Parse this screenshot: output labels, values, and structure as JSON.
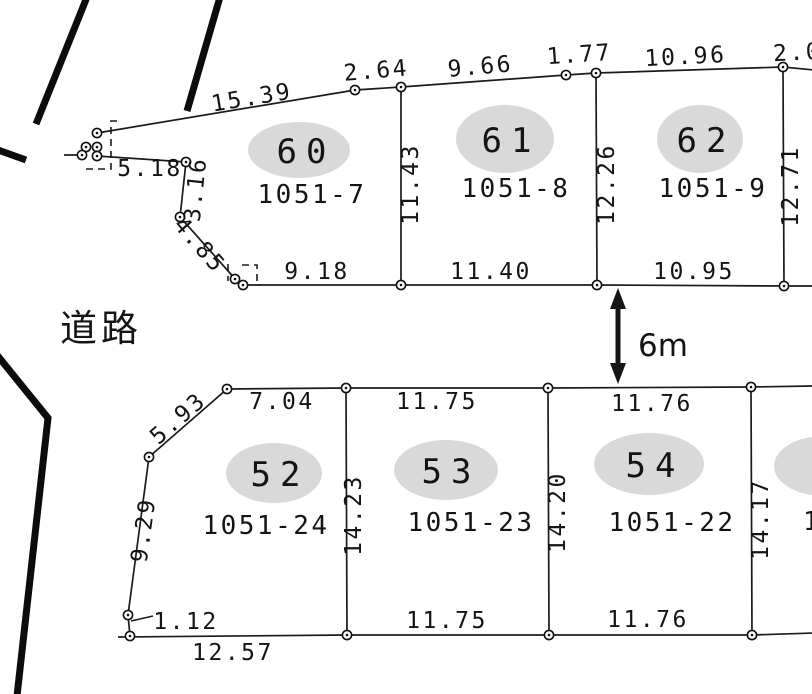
{
  "colors": {
    "paper": "#ffffff",
    "ink": "#141414",
    "road_edge": "#0c0c0c",
    "parcel_ellipse": "#d9d9d9"
  },
  "road": {
    "label": "道路",
    "width_label": "6m"
  },
  "parcels": [
    {
      "number": "60",
      "lot_id": "1051-7"
    },
    {
      "number": "61",
      "lot_id": "1051-8"
    },
    {
      "number": "62",
      "lot_id": "1051-9"
    },
    {
      "number": "52",
      "lot_id": "1051-24"
    },
    {
      "number": "53",
      "lot_id": "1051-23"
    },
    {
      "number": "54",
      "lot_id": "1051-22"
    }
  ],
  "partial_parcel": {
    "lot_id_fragment": "1"
  },
  "measurements": {
    "p60_top": "15.39",
    "p60_top_right": "2.64",
    "p61_top": "9.66",
    "p61_top_right": "1.77",
    "p62_top": "10.96",
    "p62_top_right": "2.0",
    "p60_p61_side": "11.43",
    "p61_p62_side": "12.26",
    "p62_right_side": "12.71",
    "p60_left_a": "5.18",
    "p60_left_b": "3.16",
    "p60_left_c": "4.85",
    "p60_bottom": "9.18",
    "p61_bottom": "11.40",
    "p62_bottom": "10.95",
    "p52_diagonal": "5.93",
    "p52_top": "7.04",
    "p53_top": "11.75",
    "p54_top": "11.76",
    "p52_left": "9.29",
    "p52_p53_side": "14.23",
    "p53_p54_side": "14.20",
    "p54_right_side": "14.17",
    "p52_bottom_offset": "1.12",
    "p52_bottom": "12.57",
    "p53_bottom": "11.75",
    "p54_bottom": "11.76"
  }
}
